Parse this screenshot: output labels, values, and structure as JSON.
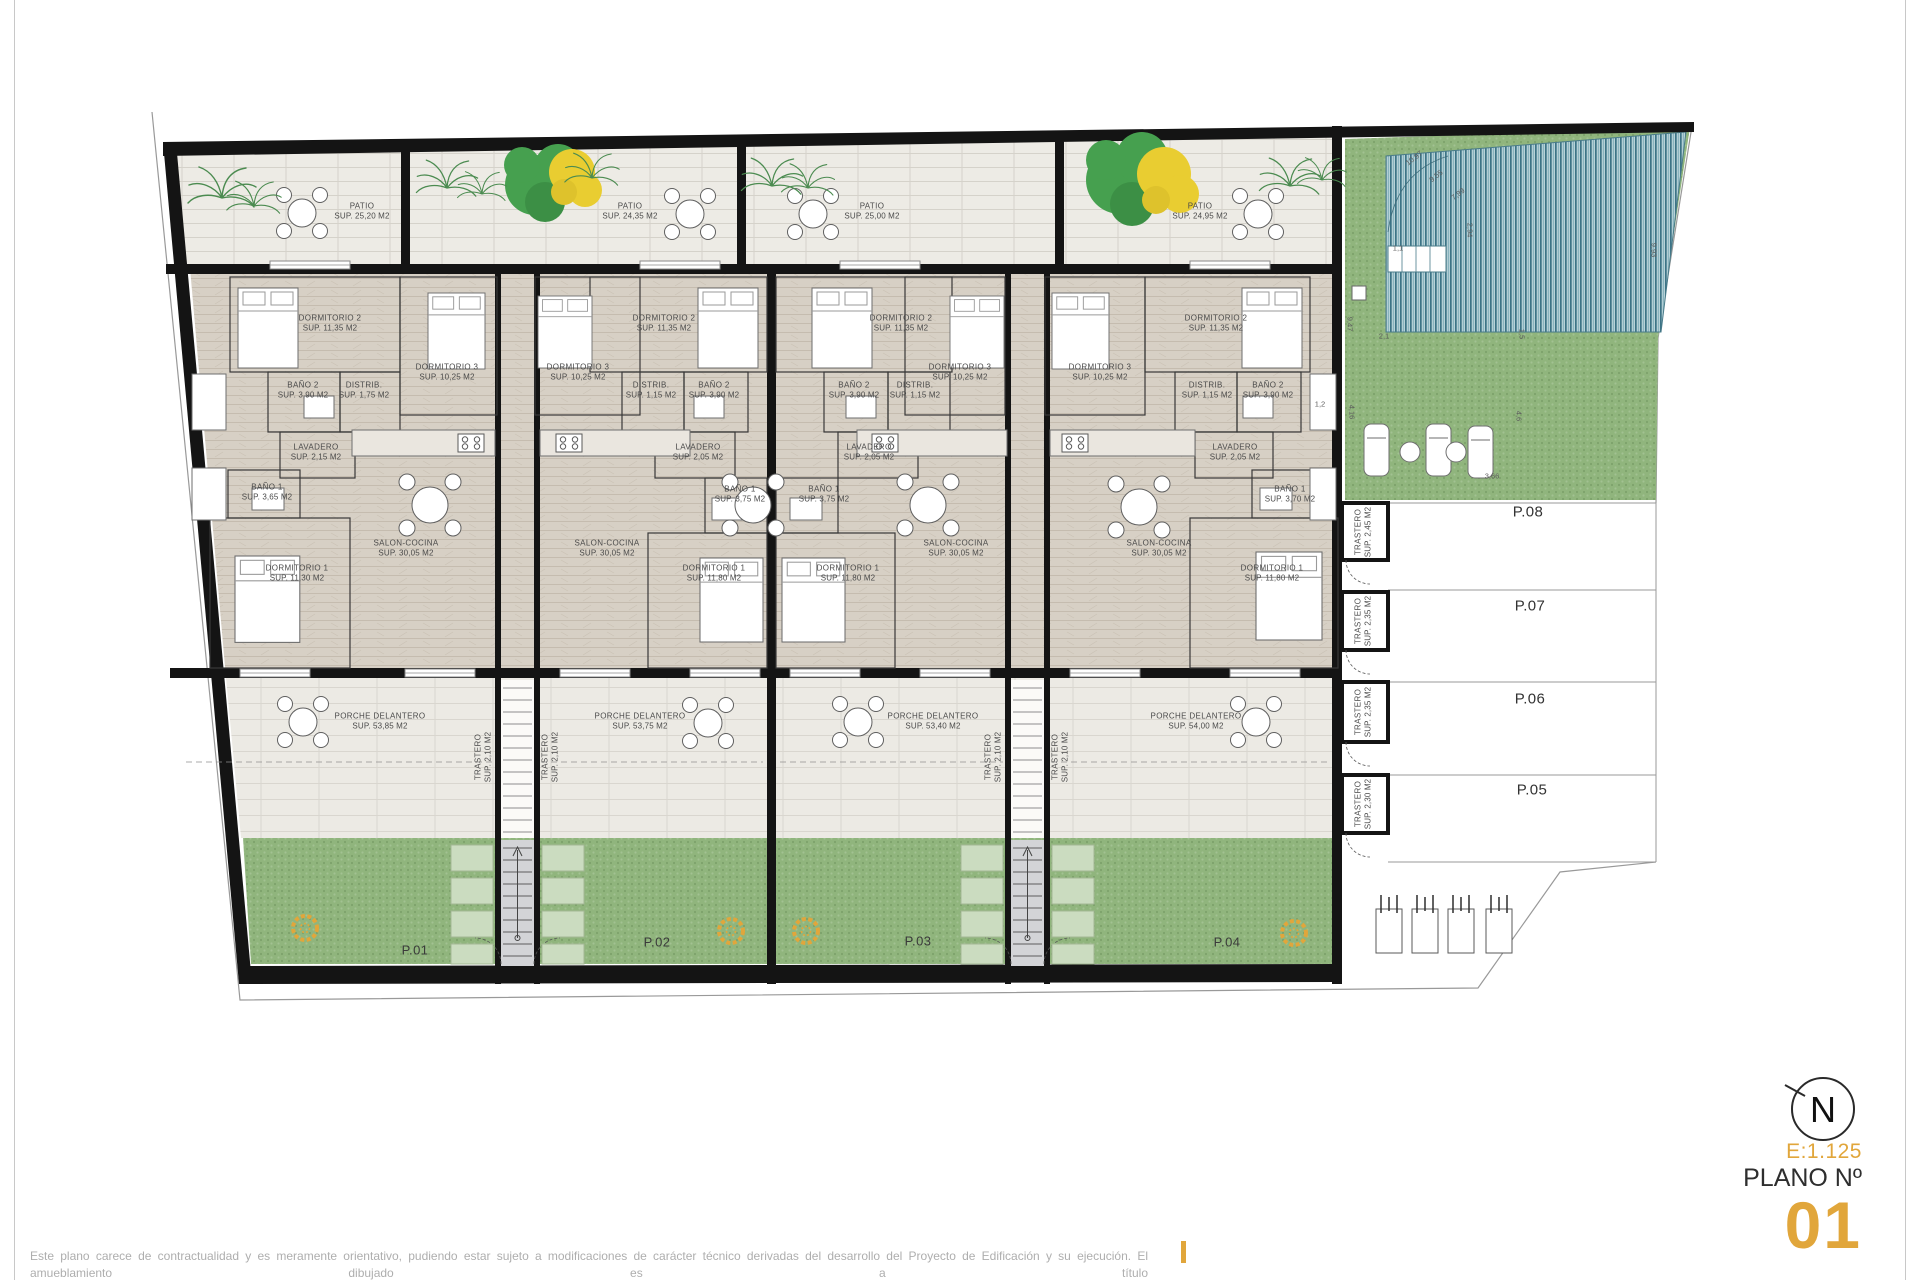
{
  "sheet": {
    "disclaimer_line1": "Este plano carece de contractualidad y es meramente orientativo, pudiendo estar sujeto a modificaciones de carácter técnico derivadas del desarrollo del Proyecto de Edificación y su ejecución. El amueblamiento dibujado es a título",
    "disclaimer_line2": "indicativo, no estando incluido en el precio los muebles, electrodomésticos ni elementos de decoración. Sólo se incluye los elementos incluidos en la memoria del Proyecto visado.",
    "scale": "E:1.125",
    "plano_label": "PLANO Nº",
    "plano_number": "01",
    "north_letter": "N",
    "accent_color": "#E1A63B"
  },
  "plan": {
    "room_labels": [
      {
        "l1": "PATIO",
        "l2": "SUP. 25,20 M2",
        "x": 362,
        "y": 212
      },
      {
        "l1": "PATIO",
        "l2": "SUP. 24,35 M2",
        "x": 630,
        "y": 212
      },
      {
        "l1": "PATIO",
        "l2": "SUP. 25,00 M2",
        "x": 872,
        "y": 212
      },
      {
        "l1": "PATIO",
        "l2": "SUP. 24,95 M2",
        "x": 1200,
        "y": 212
      },
      {
        "l1": "DORMITORIO 2",
        "l2": "SUP. 11,35 M2",
        "x": 330,
        "y": 324
      },
      {
        "l1": "DORMITORIO 3",
        "l2": "SUP. 10,25 M2",
        "x": 447,
        "y": 373
      },
      {
        "l1": "BAÑO 2",
        "l2": "SUP. 3,90 M2",
        "x": 303,
        "y": 391
      },
      {
        "l1": "DISTRIB.",
        "l2": "SUP. 1,75 M2",
        "x": 364,
        "y": 391
      },
      {
        "l1": "LAVADERO",
        "l2": "SUP. 2,15 M2",
        "x": 316,
        "y": 453
      },
      {
        "l1": "BAÑO 1",
        "l2": "SUP. 3,65 M2",
        "x": 267,
        "y": 493
      },
      {
        "l1": "SALON-COCINA",
        "l2": "SUP. 30,05 M2",
        "x": 406,
        "y": 549
      },
      {
        "l1": "DORMITORIO 1",
        "l2": "SUP. 11,30 M2",
        "x": 297,
        "y": 574
      },
      {
        "l1": "PORCHE DELANTERO",
        "l2": "SUP. 53,85 M2",
        "x": 380,
        "y": 722
      },
      {
        "l1": "DORMITORIO 2",
        "l2": "SUP. 11,35 M2",
        "x": 664,
        "y": 324
      },
      {
        "l1": "DORMITORIO 3",
        "l2": "SUP. 10,25 M2",
        "x": 578,
        "y": 373
      },
      {
        "l1": "DISTRIB.",
        "l2": "SUP. 1,15 M2",
        "x": 651,
        "y": 391
      },
      {
        "l1": "BAÑO 2",
        "l2": "SUP. 3,90 M2",
        "x": 714,
        "y": 391
      },
      {
        "l1": "LAVADERO",
        "l2": "SUP. 2,05 M2",
        "x": 698,
        "y": 453
      },
      {
        "l1": "BAÑO 1",
        "l2": "SUP. 3,75 M2",
        "x": 740,
        "y": 495
      },
      {
        "l1": "SALON-COCINA",
        "l2": "SUP. 30,05 M2",
        "x": 607,
        "y": 549
      },
      {
        "l1": "DORMITORIO 1",
        "l2": "SUP. 11,80 M2",
        "x": 714,
        "y": 574
      },
      {
        "l1": "PORCHE DELANTERO",
        "l2": "SUP. 53,75 M2",
        "x": 640,
        "y": 722
      },
      {
        "l1": "DORMITORIO 2",
        "l2": "SUP. 11,35 M2",
        "x": 901,
        "y": 324
      },
      {
        "l1": "DORMITORIO 3",
        "l2": "SUP. 10,25 M2",
        "x": 960,
        "y": 373
      },
      {
        "l1": "BAÑO 2",
        "l2": "SUP. 3,90 M2",
        "x": 854,
        "y": 391
      },
      {
        "l1": "DISTRIB.",
        "l2": "SUP. 1,15 M2",
        "x": 915,
        "y": 391
      },
      {
        "l1": "LAVADERO",
        "l2": "SUP. 2,05 M2",
        "x": 869,
        "y": 453
      },
      {
        "l1": "BAÑO 1",
        "l2": "SUP. 3,75 M2",
        "x": 824,
        "y": 495
      },
      {
        "l1": "SALON-COCINA",
        "l2": "SUP. 30,05 M2",
        "x": 956,
        "y": 549
      },
      {
        "l1": "DORMITORIO 1",
        "l2": "SUP. 11,80 M2",
        "x": 848,
        "y": 574
      },
      {
        "l1": "PORCHE DELANTERO",
        "l2": "SUP. 53,40 M2",
        "x": 933,
        "y": 722
      },
      {
        "l1": "DORMITORIO 3",
        "l2": "SUP. 10,25 M2",
        "x": 1100,
        "y": 373
      },
      {
        "l1": "DORMITORIO 2",
        "l2": "SUP. 11,35 M2",
        "x": 1216,
        "y": 324
      },
      {
        "l1": "DISTRIB.",
        "l2": "SUP. 1,15 M2",
        "x": 1207,
        "y": 391
      },
      {
        "l1": "BAÑO 2",
        "l2": "SUP. 3,90 M2",
        "x": 1268,
        "y": 391
      },
      {
        "l1": "LAVADERO",
        "l2": "SUP. 2,05 M2",
        "x": 1235,
        "y": 453
      },
      {
        "l1": "BAÑO 1",
        "l2": "SUP. 3,70 M2",
        "x": 1290,
        "y": 495
      },
      {
        "l1": "SALON-COCINA",
        "l2": "SUP. 30,05 M2",
        "x": 1159,
        "y": 549
      },
      {
        "l1": "DORMITORIO 1",
        "l2": "SUP. 11,80 M2",
        "x": 1272,
        "y": 574
      },
      {
        "l1": "PORCHE DELANTERO",
        "l2": "SUP. 54,00 M2",
        "x": 1196,
        "y": 722
      },
      {
        "l1": "TRASTERO",
        "l2": "SUP. 2,10 M2",
        "x": 484,
        "y": 757,
        "r": -90
      },
      {
        "l1": "TRASTERO",
        "l2": "SUP. 2,10 M2",
        "x": 551,
        "y": 757,
        "r": -90
      },
      {
        "l1": "TRASTERO",
        "l2": "SUP. 2,10 M2",
        "x": 994,
        "y": 757,
        "r": -90
      },
      {
        "l1": "TRASTERO",
        "l2": "SUP. 2,10 M2",
        "x": 1061,
        "y": 757,
        "r": -90
      },
      {
        "l1": "TRASTERO",
        "l2": "SUP. 2,45 M2",
        "x": 1364,
        "y": 532,
        "r": -90
      },
      {
        "l1": "TRASTERO",
        "l2": "SUP. 2,35 M2",
        "x": 1364,
        "y": 621,
        "r": -90
      },
      {
        "l1": "TRASTERO",
        "l2": "SUP. 2,35 M2",
        "x": 1364,
        "y": 712,
        "r": -90
      },
      {
        "l1": "TRASTERO",
        "l2": "SUP. 2,30 M2",
        "x": 1364,
        "y": 804,
        "r": -90
      }
    ],
    "plot_labels": [
      {
        "t": "P.01",
        "x": 415,
        "y": 950
      },
      {
        "t": "P.02",
        "x": 657,
        "y": 942
      },
      {
        "t": "P.03",
        "x": 918,
        "y": 941
      },
      {
        "t": "P.04",
        "x": 1227,
        "y": 942
      }
    ],
    "parking_labels": [
      {
        "t": "P.08",
        "x": 1528,
        "y": 512
      },
      {
        "t": "P.07",
        "x": 1530,
        "y": 606
      },
      {
        "t": "P.06",
        "x": 1530,
        "y": 699
      },
      {
        "t": "P.05",
        "x": 1532,
        "y": 790
      }
    ],
    "dim_labels": [
      {
        "t": "10,97",
        "x": 1414,
        "y": 158,
        "r": -38
      },
      {
        "t": "9,55",
        "x": 1436,
        "y": 176,
        "r": -38
      },
      {
        "t": "7,99",
        "x": 1458,
        "y": 194,
        "r": -38
      },
      {
        "t": "2,94",
        "x": 1470,
        "y": 230,
        "r": 90
      },
      {
        "t": "1,1",
        "x": 1398,
        "y": 248,
        "r": 0
      },
      {
        "t": "9,47",
        "x": 1350,
        "y": 324,
        "r": 90
      },
      {
        "t": "2,1",
        "x": 1384,
        "y": 336,
        "r": 0
      },
      {
        "t": "1,5",
        "x": 1522,
        "y": 334,
        "r": 90
      },
      {
        "t": "4,16",
        "x": 1352,
        "y": 412,
        "r": 90
      },
      {
        "t": "4,6",
        "x": 1519,
        "y": 416,
        "r": 90
      },
      {
        "t": "3,66",
        "x": 1492,
        "y": 476,
        "r": 0
      },
      {
        "t": "1,2",
        "x": 1320,
        "y": 404,
        "r": 0
      },
      {
        "t": "9,93",
        "x": 1654,
        "y": 250,
        "r": 90
      }
    ]
  }
}
